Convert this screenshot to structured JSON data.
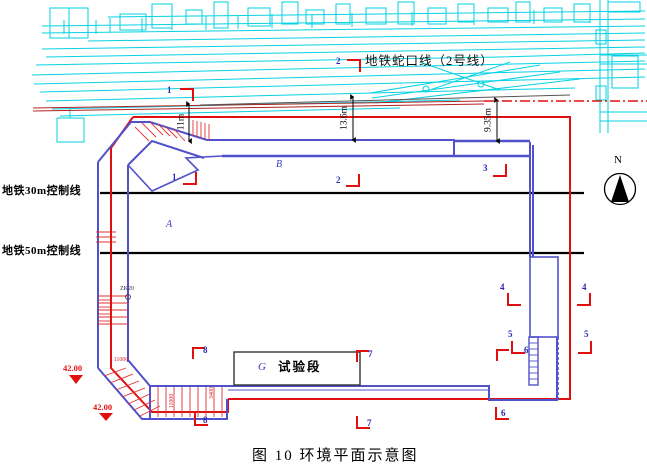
{
  "figure": {
    "caption": "图 10 环境平面示意图"
  },
  "labels": {
    "metro_line": "地铁蛇口线（2号线）",
    "control_30m": "地铁30m控制线",
    "control_50m": "地铁50m控制线"
  },
  "zones": {
    "a": "A",
    "b": "B",
    "g": "G",
    "test_section": "试验段"
  },
  "dimensions": {
    "clearance_left": "11m",
    "clearance_mid": "13.6m",
    "clearance_right": "9.35m",
    "wall_dim_horizontal": "11000",
    "ramp_dim_vertical": "11000",
    "ramp_dim_small": "3400"
  },
  "elevations": {
    "upper": "42.00",
    "lower": "42.00"
  },
  "borehole": {
    "id": "ZK20"
  },
  "compass": {
    "label": "N"
  },
  "colors": {
    "cyan": "#06d2e2",
    "pit_blue": "#5151cb",
    "boundary_red": "#e01010",
    "track_red": "#b22222",
    "black": "#000000"
  },
  "markers": [
    {
      "label": "1",
      "lx": 167,
      "ly": 86,
      "cx": 193,
      "cy": 89,
      "type": "tr"
    },
    {
      "label": "1",
      "lx": 172,
      "ly": 173,
      "cx": 196,
      "cy": 184,
      "type": "br"
    },
    {
      "label": "2",
      "lx": 336,
      "ly": 57,
      "cx": 360,
      "cy": 60,
      "type": "tr"
    },
    {
      "label": "2",
      "lx": 336,
      "ly": 176,
      "cx": 359,
      "cy": 186,
      "type": "br"
    },
    {
      "label": "3",
      "lx": 483,
      "ly": 164,
      "cx": 506,
      "cy": 176,
      "type": "br"
    },
    {
      "label": "4",
      "lx": 500,
      "ly": 283,
      "cx": 508,
      "cy": 305,
      "type": "bl"
    },
    {
      "label": "4",
      "lx": 582,
      "ly": 283,
      "cx": 590,
      "cy": 305,
      "type": "br"
    },
    {
      "label": "5",
      "lx": 508,
      "ly": 330,
      "cx": 512,
      "cy": 353,
      "type": "bl"
    },
    {
      "label": "5",
      "lx": 584,
      "ly": 330,
      "cx": 591,
      "cy": 353,
      "type": "br"
    },
    {
      "label": "6",
      "lx": 524,
      "ly": 346,
      "cx": 497,
      "cy": 350,
      "type": "tl"
    },
    {
      "label": "6",
      "lx": 501,
      "ly": 409,
      "cx": 496,
      "cy": 419,
      "type": "bl"
    },
    {
      "label": "7",
      "lx": 368,
      "ly": 350,
      "cx": 357,
      "cy": 351,
      "type": "tl"
    },
    {
      "label": "7",
      "lx": 367,
      "ly": 419,
      "cx": 357,
      "cy": 428,
      "type": "bl"
    },
    {
      "label": "8",
      "lx": 203,
      "ly": 346,
      "cx": 193,
      "cy": 348,
      "type": "tl"
    },
    {
      "label": "8",
      "lx": 203,
      "ly": 416,
      "cx": 195,
      "cy": 425,
      "type": "bl"
    }
  ]
}
